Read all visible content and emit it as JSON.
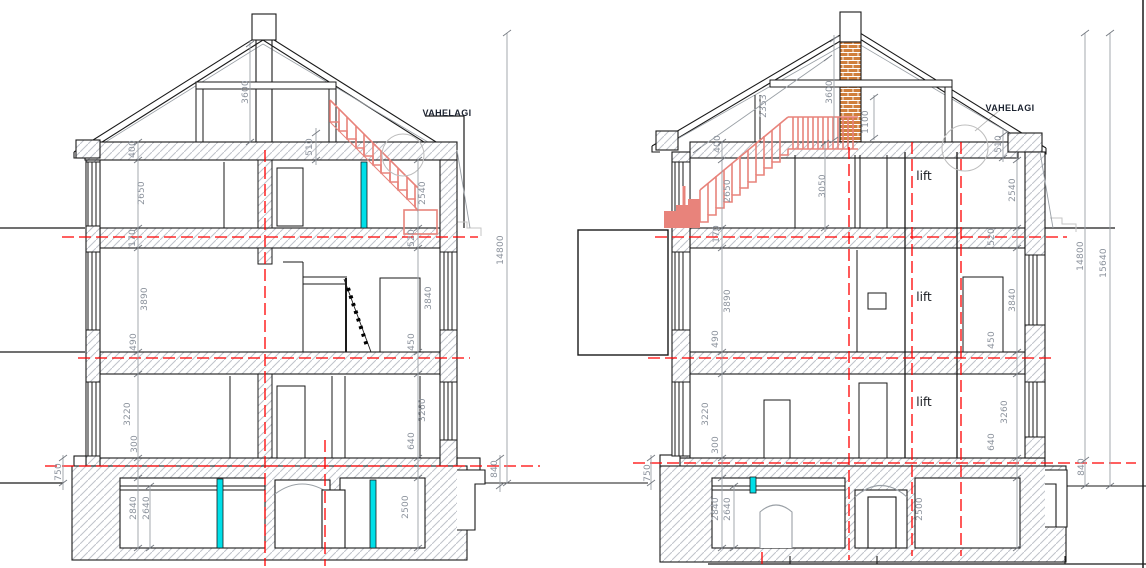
{
  "labels": {
    "vahelagi": "VAHELAGI",
    "lift": "lift"
  },
  "colors": {
    "axis_red": "#ff0000",
    "stair_red": "#e8837b",
    "door_cyan": "#00dfe8",
    "brick_orange": "#d07f3c",
    "dim_text_gray": "#8b929c",
    "hatch_gray": "#bfc3ca"
  },
  "left_section": {
    "dims": {
      "d3600": "3600",
      "d400": "400",
      "d510": "510",
      "d2650": "2650",
      "d2540": "2540",
      "d170": "170",
      "d520": "520",
      "d3890": "3890",
      "d3840": "3840",
      "d490": "490",
      "d450": "450",
      "d3220": "3220",
      "d3260": "3260",
      "d300": "300",
      "d640": "640",
      "d750": "750",
      "d2840": "2840",
      "d2640": "2640",
      "d2500": "2500",
      "d840": "840",
      "d14800": "14800"
    }
  },
  "right_section": {
    "dims": {
      "d2353": "2353",
      "d3600": "3600",
      "d1100": "1100",
      "d400": "400",
      "d510": "510",
      "d2650": "2650",
      "d3050": "3050",
      "d2540": "2540",
      "d170": "170",
      "d520": "520",
      "d3890": "3890",
      "d3840": "3840",
      "d490": "490",
      "d450": "450",
      "d3220": "3220",
      "d3260": "3260",
      "d300": "300",
      "d640": "640",
      "d750": "750",
      "d2840": "2840",
      "d2640": "2640",
      "d2500": "2500",
      "d840": "840",
      "d14800": "14800",
      "d15640": "15640"
    }
  }
}
